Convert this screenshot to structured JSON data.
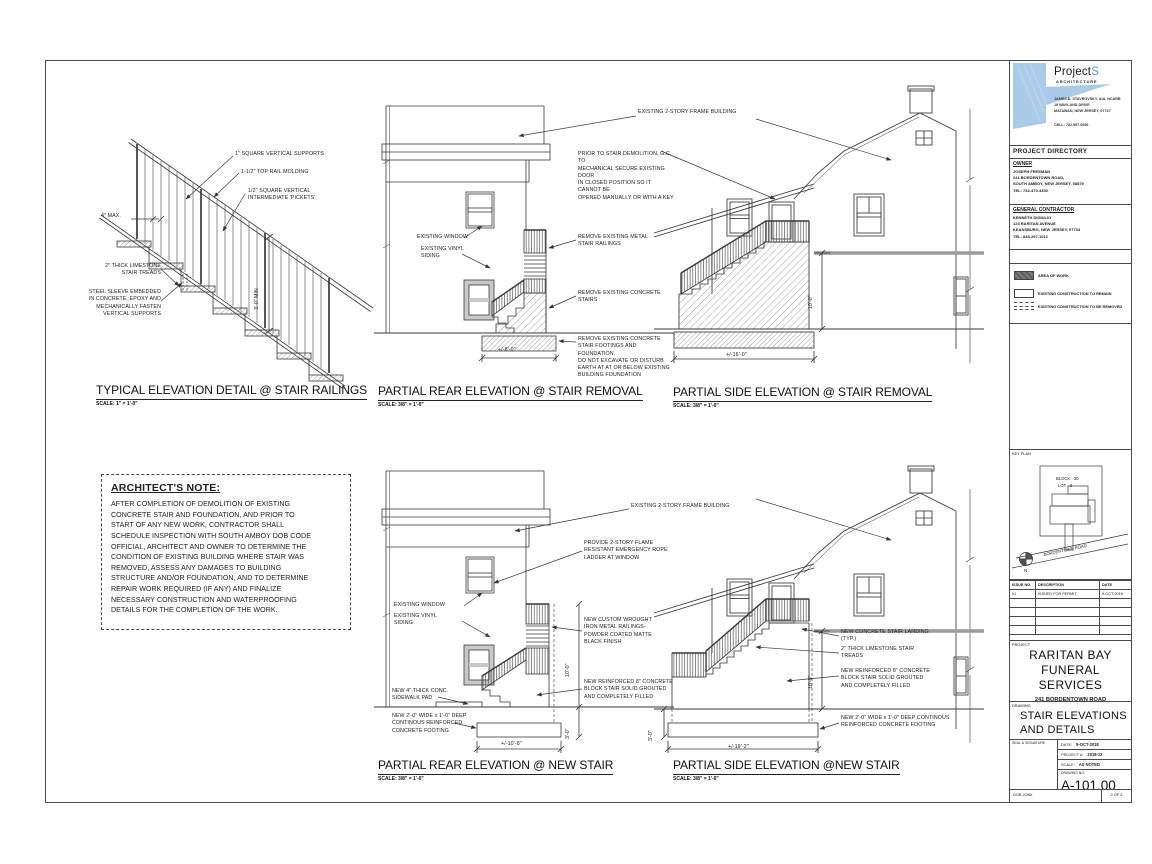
{
  "logo": {
    "brand": "Project",
    "brand_accent": "S",
    "tagline": "ARCHITECTURE",
    "architect_lines": "JAMES D. STAVROVSKY, AIA, NCARB\n19 WAYLAND DRIVE\nMATAWAN, NEW JERSEY, 07747",
    "cell_line": "CELL: 732.997.0956",
    "accent_color": "#a9cbe8"
  },
  "directory": {
    "header": "PROJECT DIRECTORY",
    "owner_label": "OWNER",
    "owner_lines": "JOSEPH FREEMAN\n241 BORDENTOWN ROAD,\nSOUTH AMBOY, NEW JERSEY, 08879\nTEL: 732-470-4330",
    "gc_label": "GENERAL CONTRACTOR",
    "gc_lines": "KENNETH DIGIULIO\n123 RARITAN AVENUE\nKEANSBURG, NEW JERSEY, 07734\nTEL: 848-297-1012"
  },
  "legend": {
    "area_of_work": "AREA OF WORK",
    "remain": "EXISTING CONSTRUCTION TO REMAIN",
    "removed": "EXISTING CONSTRUCTION TO BE REMOVED"
  },
  "keyplan": {
    "label": "KEY PLAN",
    "block": "BLOCK - 30",
    "lot": "LOT - 8",
    "road": "BORDENTOWN ROAD",
    "north": "N"
  },
  "issues": {
    "headers": [
      "ISSUE NO.",
      "DESCRIPTION",
      "DATE"
    ],
    "row1": [
      "01",
      "ISSUED FOR PERMIT",
      "9-OCT-2018"
    ]
  },
  "project": {
    "label": "PROJECT",
    "name_line1": "RARITAN BAY",
    "name_line2": "FUNERAL SERVICES",
    "address": "241 BORDENTOWN ROAD\nSOUTH AMBOY, NEW JERSEY\nCONSTRUCTION MODIFICATIONS"
  },
  "drawing_title": {
    "label": "DRAWING",
    "lines": "STAIR ELEVATIONS\nAND DETAILS"
  },
  "stamp": {
    "seal_label": "SEAL & SIGNATURE",
    "date_label": "DATE:",
    "date": "9-OCT-2018",
    "project_no_label": "PROJECT #:",
    "project_no": "2018-12",
    "scale_label": "SCALE:",
    "scale": "AS NOTED",
    "drawing_no_label": "DRAWING NO:",
    "drawing_no": "A-101.00",
    "dob_label": "DOB JOB#",
    "sheet": "2 OF 2"
  },
  "panels": {
    "railing": {
      "title": "TYPICAL ELEVATION DETAIL @ STAIR RAILINGS",
      "scale": "SCALE: 1\" = 1'-0\"",
      "labels": {
        "supports": "1\" SQUARE VERTICAL SUPPORTS",
        "top_rail": "1-1/2\" TOP RAIL MOLDING",
        "pickets": "1/2\" SQUARE VERTICAL\nINTERMEDIATE 'PICKETS'",
        "max": "4\" MAX.",
        "treads": "2\" THICK LIMESTONE\nSTAIR TREADS",
        "sleeve": "STEEL SLEEVE EMBEDDED\nIN CONCRETE. EPOXY AND\nMECHANICALLY FASTEN\nVERTICAL SUPPORTS",
        "min_height": "3'-0\" MIN"
      }
    },
    "rear_removal": {
      "title": "PARTIAL REAR ELEVATION @ STAIR REMOVAL",
      "scale": "SCALE: 3/8\" = 1'-0\"",
      "labels": {
        "building": "EXISTING 2-STORY FRAME BUILDING",
        "door_note": "PRIOR TO STAIR DEMOLITION, G.C. TO\nMECHANICAL SECURE EXISTING DOOR\nIN CLOSED POSITION SO IT CANNOT BE\nOPENED MANUALLY OR WITH A KEY",
        "window": "EXISTING WINDOW",
        "siding": "EXISTING VINYL\nSIDING",
        "railings": "REMOVE EXISTING METAL\nSTAIR RAILINGS",
        "stairs": "REMOVE EXISTING CONCRETE\nSTAIRS",
        "footings": "REMOVE EXISTING CONCRETE\nSTAIR FOOTINGS AND FOUNDATION.\nDO NOT EXCAVATE OR DISTURB\nEARTH AT AT OR BELOW EXISTING\nBUILDING FOUNDATION",
        "dim_width": "+/-8'-0\""
      }
    },
    "side_removal": {
      "title": "PARTIAL SIDE ELEVATION @ STAIR REMOVAL",
      "scale": "SCALE: 3/8\" = 1'-0\"",
      "labels": {
        "dim_height": "10'-0\"",
        "dim_width": "+/-16'-0\""
      }
    },
    "note": {
      "title": "ARCHITECT'S NOTE:",
      "body": "AFTER COMPLETION OF DEMOLITION OF EXISTING\nCONCRETE STAIR AND FOUNDATION, AND PRIOR TO\nSTART OF ANY NEW WORK, CONTRACTOR SHALL\nSCHEDULE INSPECTION WITH SOUTH AMBOY DOB CODE\nOFFICIAL, ARCHITECT AND OWNER TO DETERMINE THE\nCONDITION OF EXISTING BUILDING WHERE STAIR WAS\nREMOVED, ASSESS ANY DAMAGES TO BUILDING\nSTRUCTURE AND/OR FOUNDATION, AND TO DETERMINE\nREPAIR WORK REQUIRED (IF ANY) AND FINALIZE\nNECESSARY CONSTRUCTION AND WATERPROOFING\nDETAILS FOR THE COMPLETION OF THE WORK."
    },
    "rear_new": {
      "title": "PARTIAL REAR ELEVATION @ NEW STAIR",
      "scale": "SCALE: 3/8\" = 1'-0\"",
      "labels": {
        "building": "EXISTING 2-STORY FRAME BUILDING",
        "ladder": "PROVIDE 2-STORY FLAME\nRESISTANT EMERGENCY ROPE\nLADDER AT WINDOW",
        "window": "EXISTING WINDOW",
        "siding": "EXISTING VINYL\nSIDING",
        "railings": "NEW CUSTOM WROUGHT\nIRON METAL RAILINGS-\nPOWDER COATED MATTE\nBLACK FINISH",
        "block_stair": "NEW REINFORCED 8\" CONCRETE\nBLOCK STAIR SOLID GROUTED\nAND COMPLETELY FILLED",
        "sidewalk": "NEW 4\" THICK CONC.\nSIDEWALK PAD",
        "footing": "NEW 2'-0\" WIDE x 1'-0\" DEEP\nCONTINOUS REINFORCED\nCONCRETE FOOTING",
        "dim_height": "10'-0\"",
        "dim_footing": "3'-0\"",
        "dim_width": "+/-10'-8\""
      }
    },
    "side_new": {
      "title": "PARTIAL SIDE ELEVATION @NEW STAIR",
      "scale": "SCALE: 3/8\" = 1'-0\"",
      "labels": {
        "landing": "NEW CONCRETE STAIR LANDING\n(TYP.)",
        "treads": "2\" THICK LIMESTONE STAIR\nTREADS",
        "block_stair": "NEW REINFORCED 8\" CONCRETE\nBLOCK STAIR SOLID GROUTED\nAND COMPLETELY FILLED",
        "footing": "NEW 2'-0\" WIDE x 1'-0\" DEEP CONTINOUS\nREINFORCED CONCRETE FOOTING",
        "dim_height": "10'-0\"",
        "dim_footing": "3'-0\"",
        "dim_width": "+/-19'-2\""
      }
    }
  }
}
